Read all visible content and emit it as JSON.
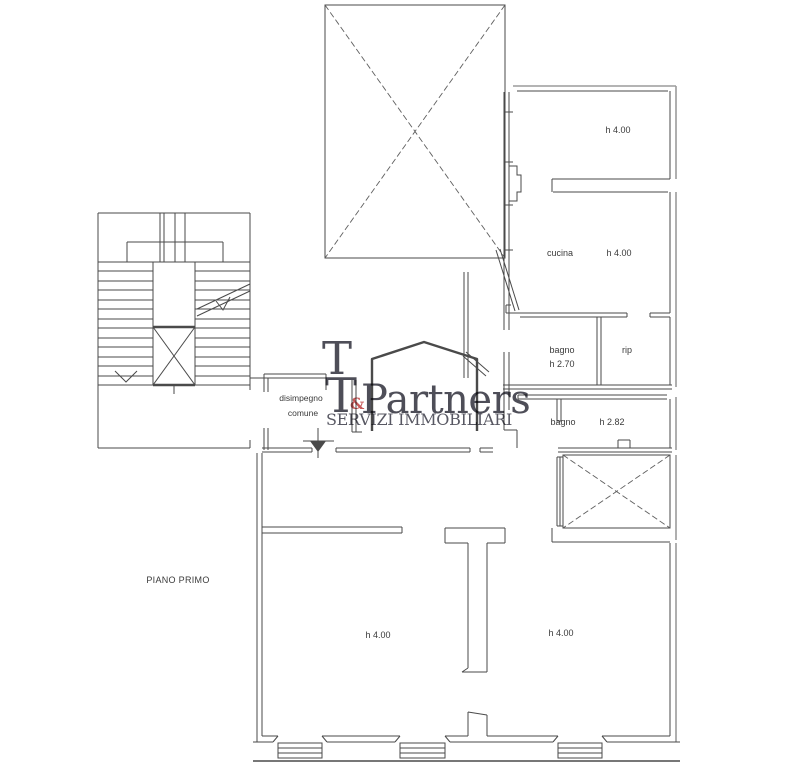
{
  "floor_plan": {
    "floor_label": "PIANO PRIMO",
    "rooms": {
      "camera_top_right": {
        "height": "h 4.00"
      },
      "cucina": {
        "name": "cucina",
        "height": "h 4.00"
      },
      "bagno_1": {
        "name": "bagno",
        "height": "h 2.70"
      },
      "ripostiglio": {
        "name": "rip"
      },
      "bagno_2": {
        "name": "bagno",
        "height": "h 2.82"
      },
      "disimpegno": {
        "name_line_1": "disimpegno",
        "name_line_2": "comune"
      },
      "camera_bottom_left": {
        "height": "h 4.00"
      },
      "camera_bottom_right": {
        "height": "h 4.00"
      }
    }
  },
  "watermark": {
    "letter_top": "T",
    "letter_bottom": "T",
    "ampersand": "&",
    "brand": "Partners",
    "tagline": "SERVIZI IMMOBILIARI",
    "colors": {
      "brand_text": "#3f3f49",
      "tagline_text": "#4a4a55",
      "ampersand": "#c24b4b",
      "house_outline": "#d28983"
    }
  },
  "drawing": {
    "background": "#ffffff",
    "line_color": "#4a4a4a",
    "outer_line_color": "#9b9b9b"
  }
}
